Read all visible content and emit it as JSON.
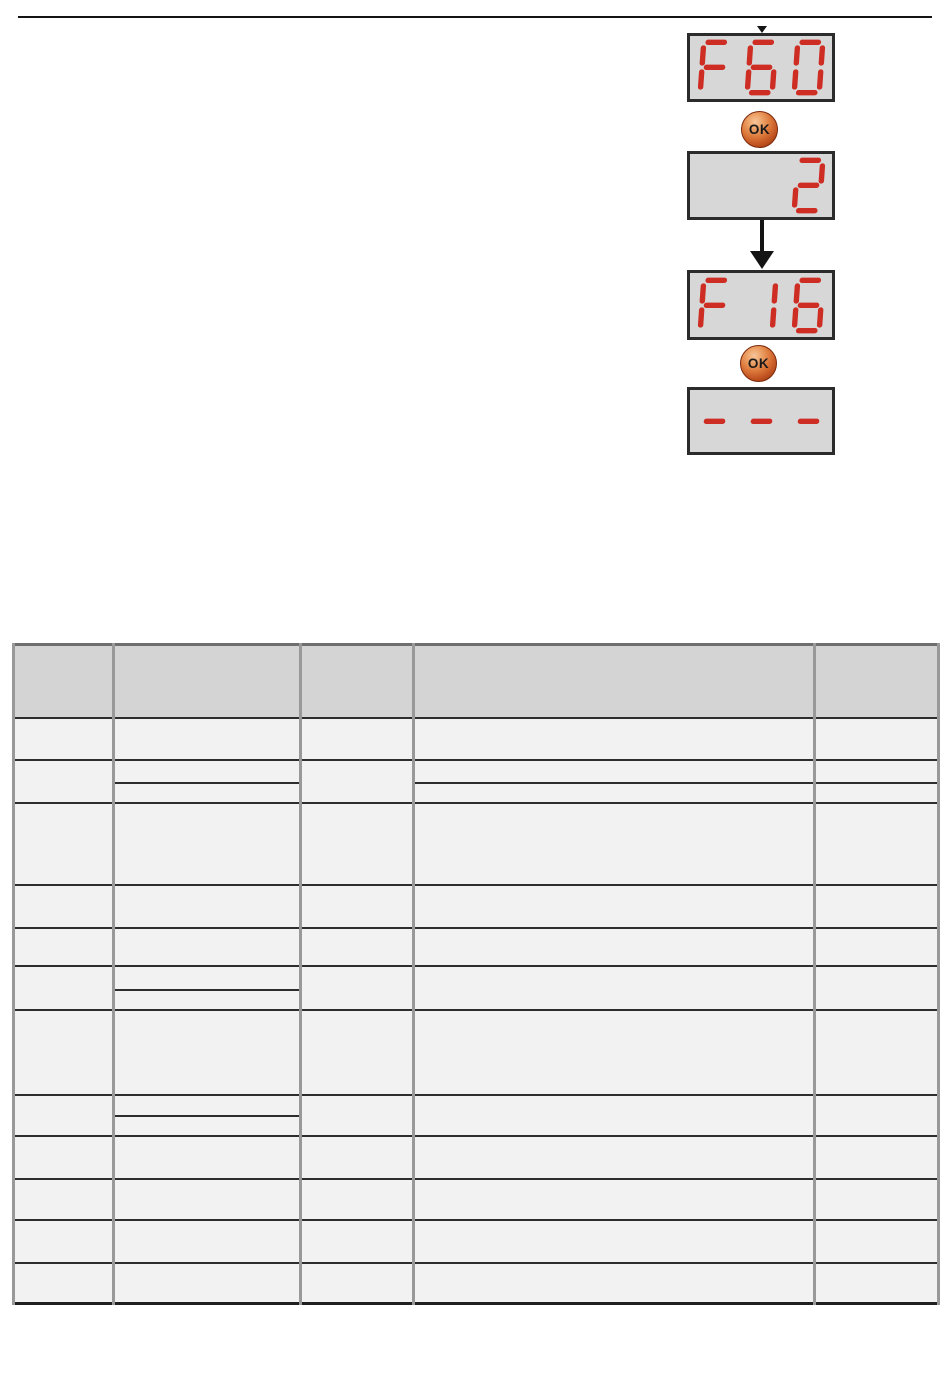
{
  "page": {
    "background": "#ffffff",
    "rule_color": "#141414"
  },
  "flow": {
    "ok_label": "OK",
    "displays": [
      "F60",
      "  2",
      "F16",
      "---"
    ],
    "colors": {
      "segment_red": "#cd2d22",
      "display_bg": "#d7d7d7",
      "display_border": "#2b2b2b",
      "arrow": "#141414",
      "ok_light": "#f7c49a",
      "ok_mid": "#dd7a3c",
      "ok_deep": "#c25422",
      "ok_dark": "#96350f",
      "ok_text": "#1a1a1a"
    }
  },
  "table": {
    "column_count": 5,
    "body_row_count": 12,
    "header_bg": "#d4d4d4",
    "body_bg": "#f2f2f2",
    "vertical_grid": "#999999",
    "horizontal_grid": "#2d2d2d",
    "outer_border": "#6e6e6e",
    "bottom_border": "#1f1f1f"
  }
}
